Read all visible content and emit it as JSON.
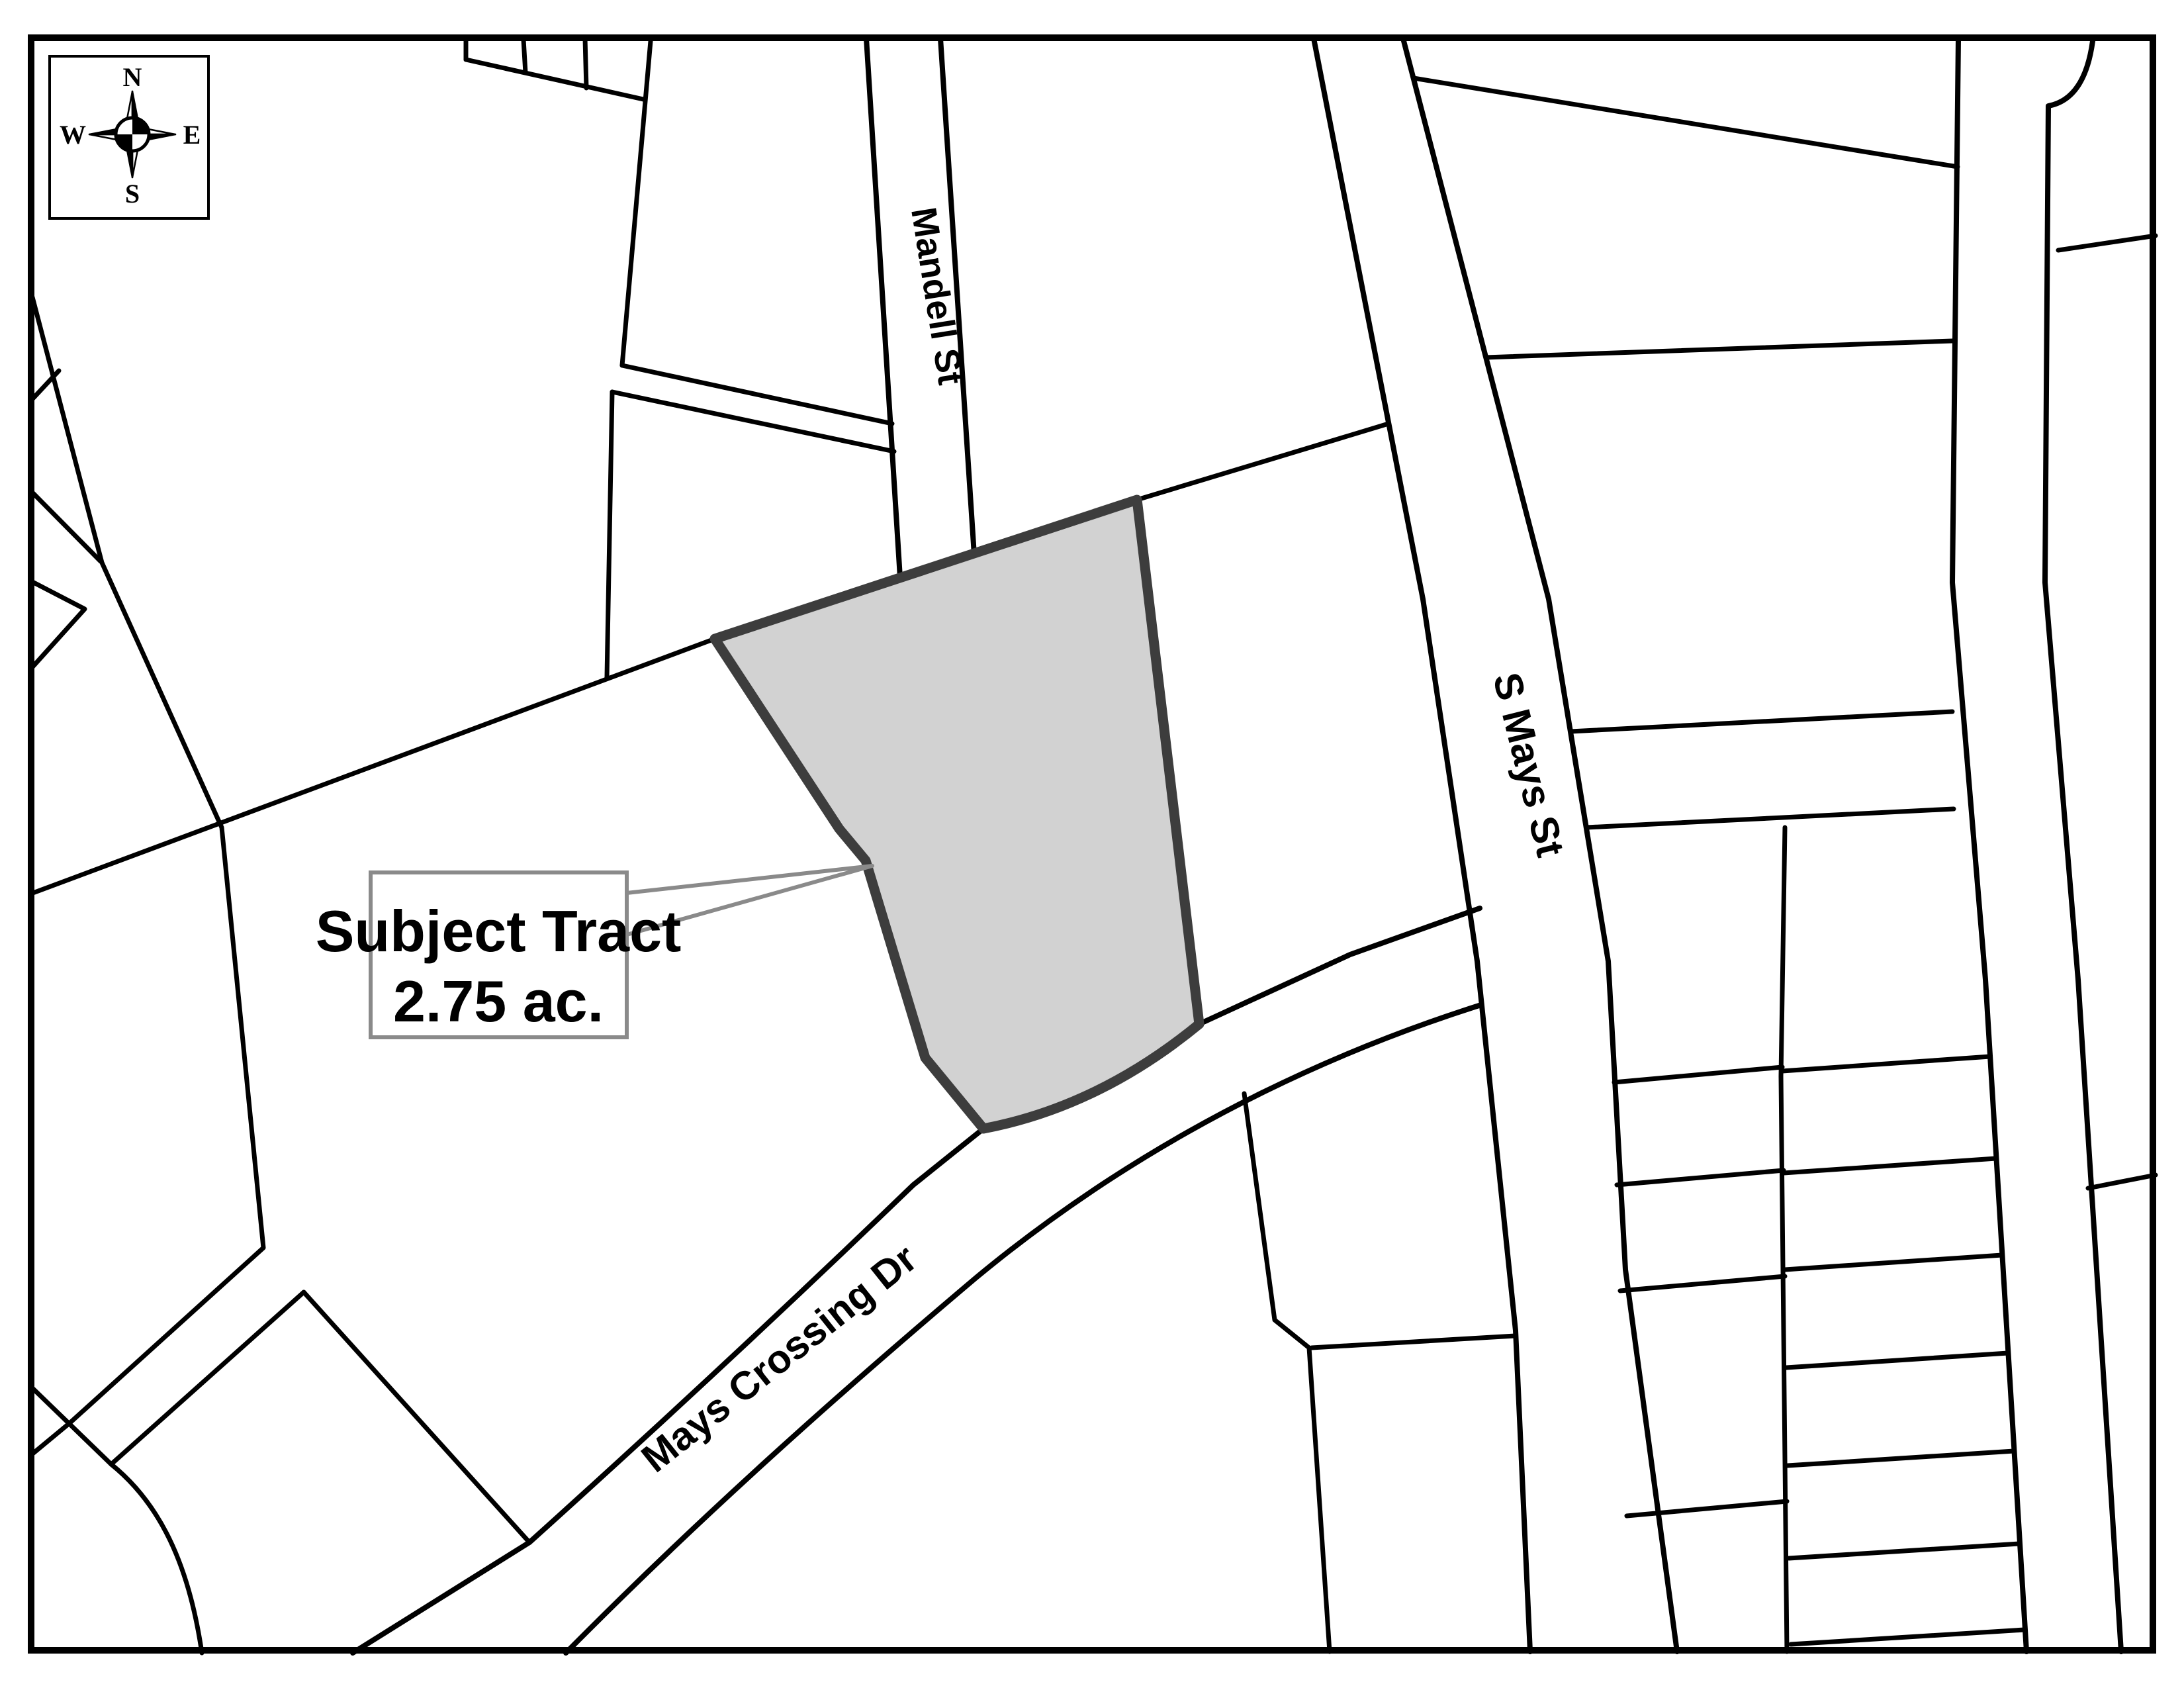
{
  "compass": {
    "north": "N",
    "south": "S",
    "east": "E",
    "west": "W"
  },
  "streets": [
    {
      "label": "Mandell St"
    },
    {
      "label": "S Mays St"
    },
    {
      "label": "Mays Crossing Dr"
    }
  ],
  "callout": {
    "line1": "Subject Tract",
    "line2": "2.75 ac."
  },
  "colors": {
    "background": "#ffffff",
    "parcel_line": "#000000",
    "tract_fill": "#d2d2d2",
    "tract_border": "#3d3d3d",
    "callout_border": "#8a8a8a",
    "callout_fill": "#ffffff"
  }
}
